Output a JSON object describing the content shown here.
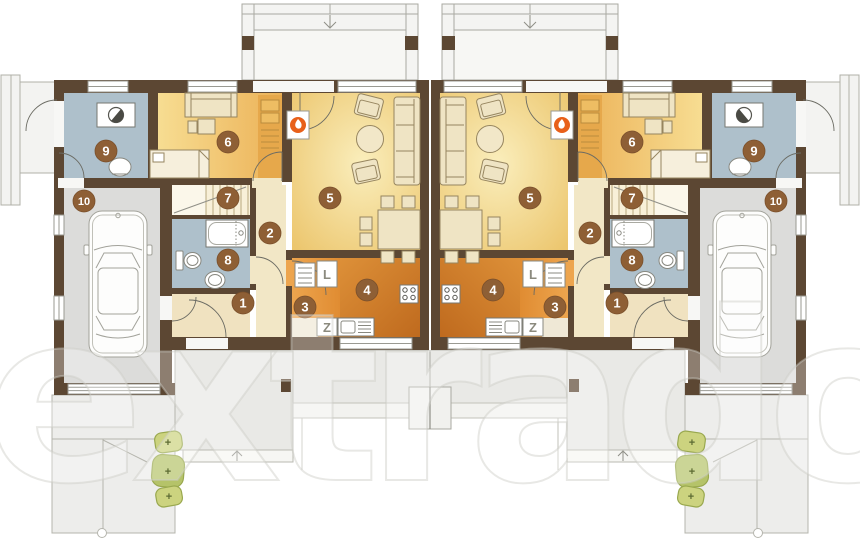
{
  "plan": {
    "type": "duplex-floor-plan",
    "watermark_text": "extradom",
    "room_numbers": [
      "1",
      "2",
      "3",
      "4",
      "5",
      "6",
      "7",
      "8",
      "9",
      "10"
    ],
    "appliances": {
      "fridge": "L",
      "dishwasher": "Z"
    },
    "bush_symbol": "+",
    "icons": {
      "fireplace": "orange-circle-with-white-flame",
      "washing_machine": "half-shaded-drum-in-box",
      "entrance_arrows": "down-arrow-back-terrace-and-up-arrow-front-step"
    },
    "colors": {
      "wall": "#5c4733",
      "utility_bath_floor": "#aec0cb",
      "bedroom_floor_light": "#f7dd92",
      "bedroom_floor_dark": "#ecb258",
      "living_floor_light": "#faeebc",
      "living_floor_dark": "#ecc66e",
      "kitchen_floor_light": "#dd9038",
      "kitchen_floor_dark": "#bf6a1e",
      "hall_floor": "#f2e7c6",
      "entry_floor": "#f0e2c0",
      "garage_floor": "#dcdcda",
      "terrace_gray": "#e9e9e6",
      "exterior_structure": "#f4f4f2",
      "bush_green": "#c5cf7d",
      "bush_green_dark": "#b5c369",
      "badge_brown": "#8e5f35",
      "fireplace_accent": "#e8601a",
      "furniture_cream": "#efe4c4"
    }
  }
}
